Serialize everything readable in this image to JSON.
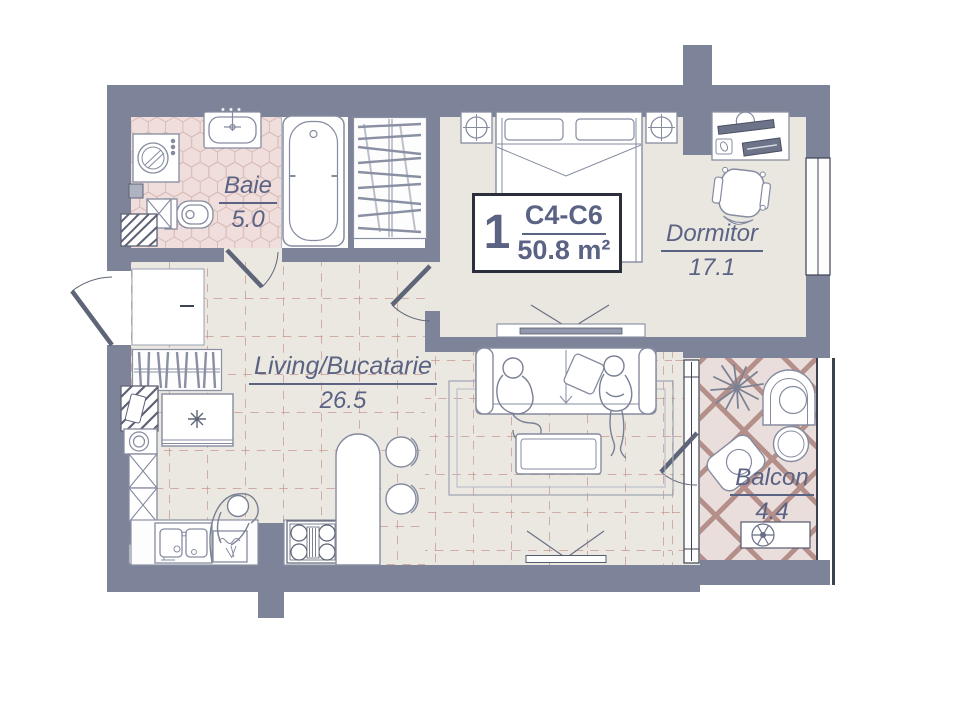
{
  "unit": {
    "number": "1",
    "code": "C4-C6",
    "area": "50.8 m²"
  },
  "rooms": {
    "baie": {
      "name": "Baie",
      "area": "5.0"
    },
    "dormitor": {
      "name": "Dormitor",
      "area": "17.1"
    },
    "living": {
      "name": "Living/Bucatarie",
      "area": "26.5"
    },
    "balcon": {
      "name": "Balcon",
      "area": "4.4"
    }
  },
  "colors": {
    "wall": "#7d8398",
    "living_floor": "#eae8e1",
    "bedroom_floor": "#e9e7e0",
    "bathroom_tile": "#efdedc",
    "bathroom_tile_line": "#d8bab8",
    "balcony_tile": "#e9dedb",
    "balcony_lattice": "#b5908a",
    "floor_grid_line": "#c38c84",
    "label_text": "#5b6384",
    "furniture_stroke": "#868ca0"
  }
}
